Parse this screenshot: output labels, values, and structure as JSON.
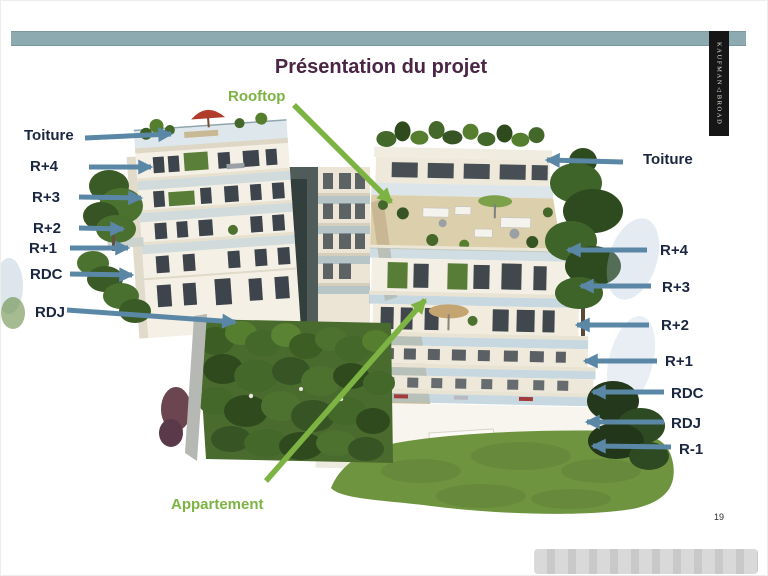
{
  "slide": {
    "title": "Présentation du projet",
    "page_number": "19"
  },
  "brand": {
    "word_top": "KAUFMAN",
    "symbol": "△",
    "word_bottom": "BROAD"
  },
  "annotations": {
    "green": {
      "rooftop": "Rooftop",
      "apartment": "Appartement"
    },
    "left_floors": [
      "Toiture",
      "R+4",
      "R+3",
      "R+2",
      "R+1",
      "RDC",
      "RDJ"
    ],
    "right_floors": [
      "Toiture",
      "R+4",
      "R+3",
      "R+2",
      "R+1",
      "RDC",
      "RDJ",
      "R-1"
    ]
  },
  "colors": {
    "accent_bar": "#8caab0",
    "title_text": "#4a2545",
    "floor_label_text": "#1b2740",
    "arrow_blue": "#5b87a6",
    "annotation_green": "#7cb342",
    "brand_background": "#161616",
    "grass": "#6f9440",
    "building_wall": "#f4f0e6"
  }
}
